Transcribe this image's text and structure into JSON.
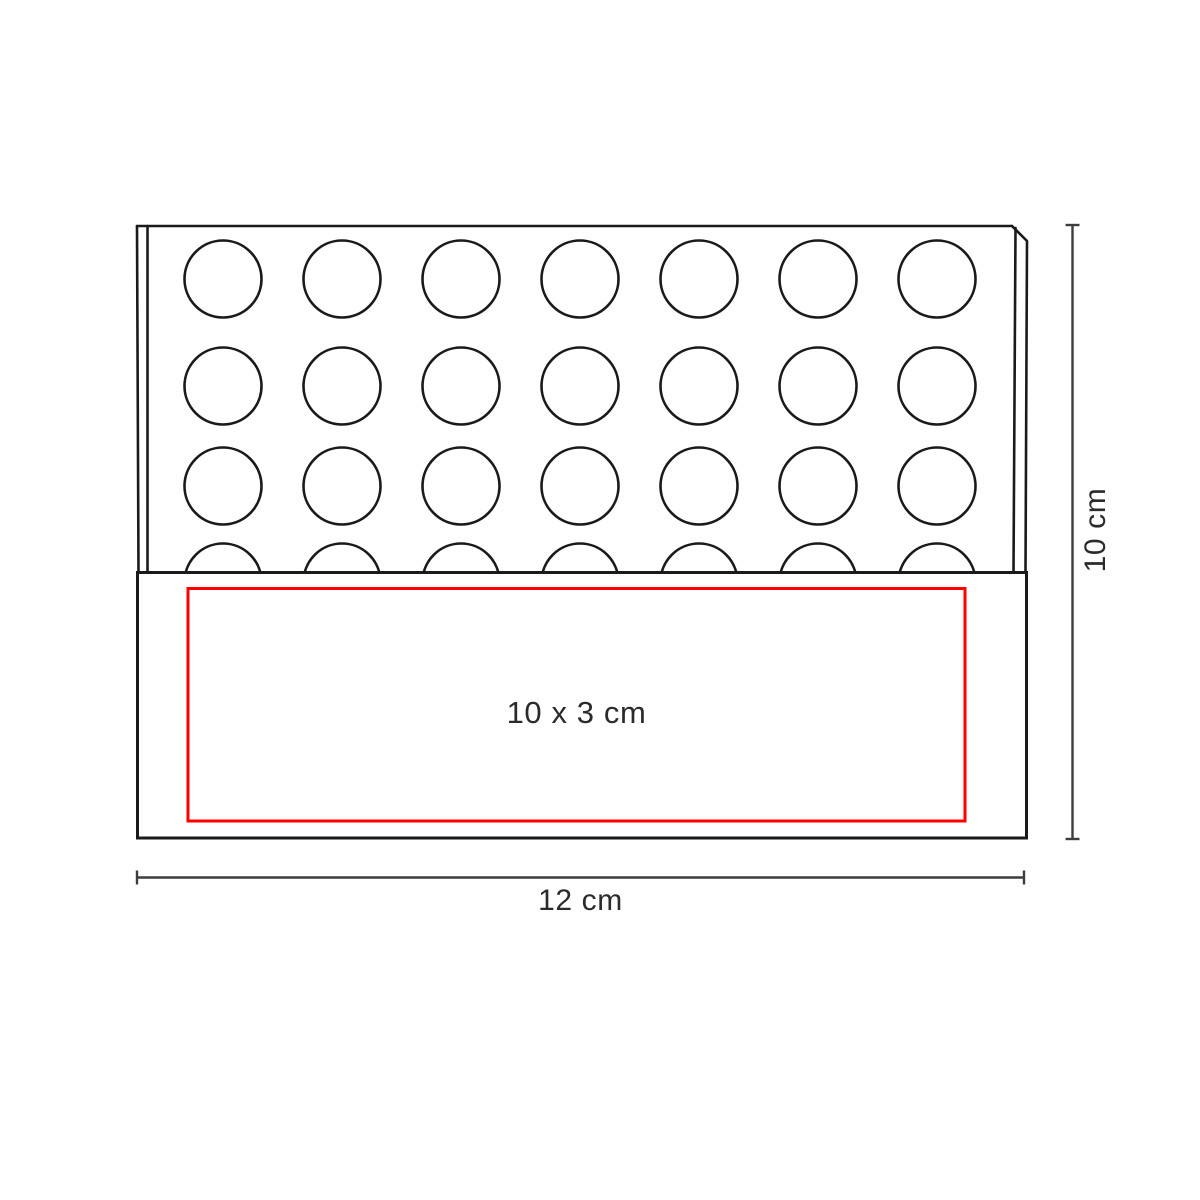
{
  "diagram": {
    "kind": "product-dimension-diagram",
    "labels": {
      "print_area": "10 x 3 cm",
      "width": "12 cm",
      "height": "10 cm"
    },
    "board": {
      "hole_columns": 7,
      "hole_rows": 4
    },
    "colors": {
      "background": "#ffffff",
      "outline": "#1a1a1a",
      "dimension_line": "#3d3d3d",
      "print_area_outline": "#fe0000",
      "label_text": "#2b2b2b"
    }
  }
}
